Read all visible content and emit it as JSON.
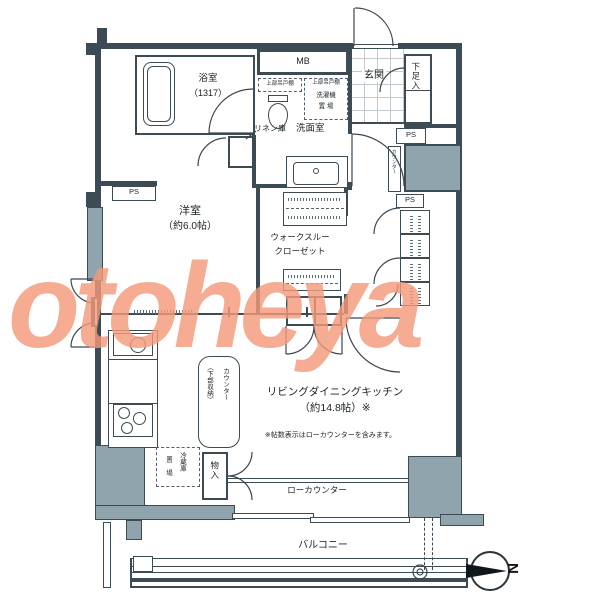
{
  "watermark": "otoheya",
  "compass": {
    "north_label": "N"
  },
  "rooms": {
    "bathroom": {
      "label": "浴室",
      "size": "（1317）"
    },
    "washroom": {
      "label": "洗面室"
    },
    "entrance": {
      "label": "玄関"
    },
    "western_room": {
      "label": "洋室",
      "size": "（約6.0帖）"
    },
    "walk_through_closet": {
      "line1": "ウォークスルー",
      "line2": "クローゼット"
    },
    "ldk": {
      "label": "リビングダイニングキッチン",
      "size": "（約14.8帖）※",
      "note": "※帖数表示はローカウンターを含みます。"
    },
    "balcony": {
      "label": "バルコニー"
    }
  },
  "fixtures": {
    "mb": "MB",
    "shoe_cabinet": "下足入",
    "ps_west": "PS",
    "ps_right_upper": "PS",
    "ps_right_lower": "PS",
    "meter_counter": "カウンター",
    "linen": "リネン庫",
    "upper_cabinet_left": "上部吊戸棚",
    "upper_cabinet_right": "上部吊戸棚",
    "washer_line1": "洗濯機",
    "washer_line2": "置 場",
    "island_counter_line1": "カウンター",
    "island_counter_line2": "（下部収納）",
    "fridge_line1": "冷蔵庫",
    "fridge_line2": "置 場",
    "storage": "物入",
    "low_counter": "ローカウンター"
  },
  "colors": {
    "wall": "#3d4b54",
    "column": "#90a4ae",
    "watermark": "#f39a7b",
    "tile": "#c2cad0"
  }
}
